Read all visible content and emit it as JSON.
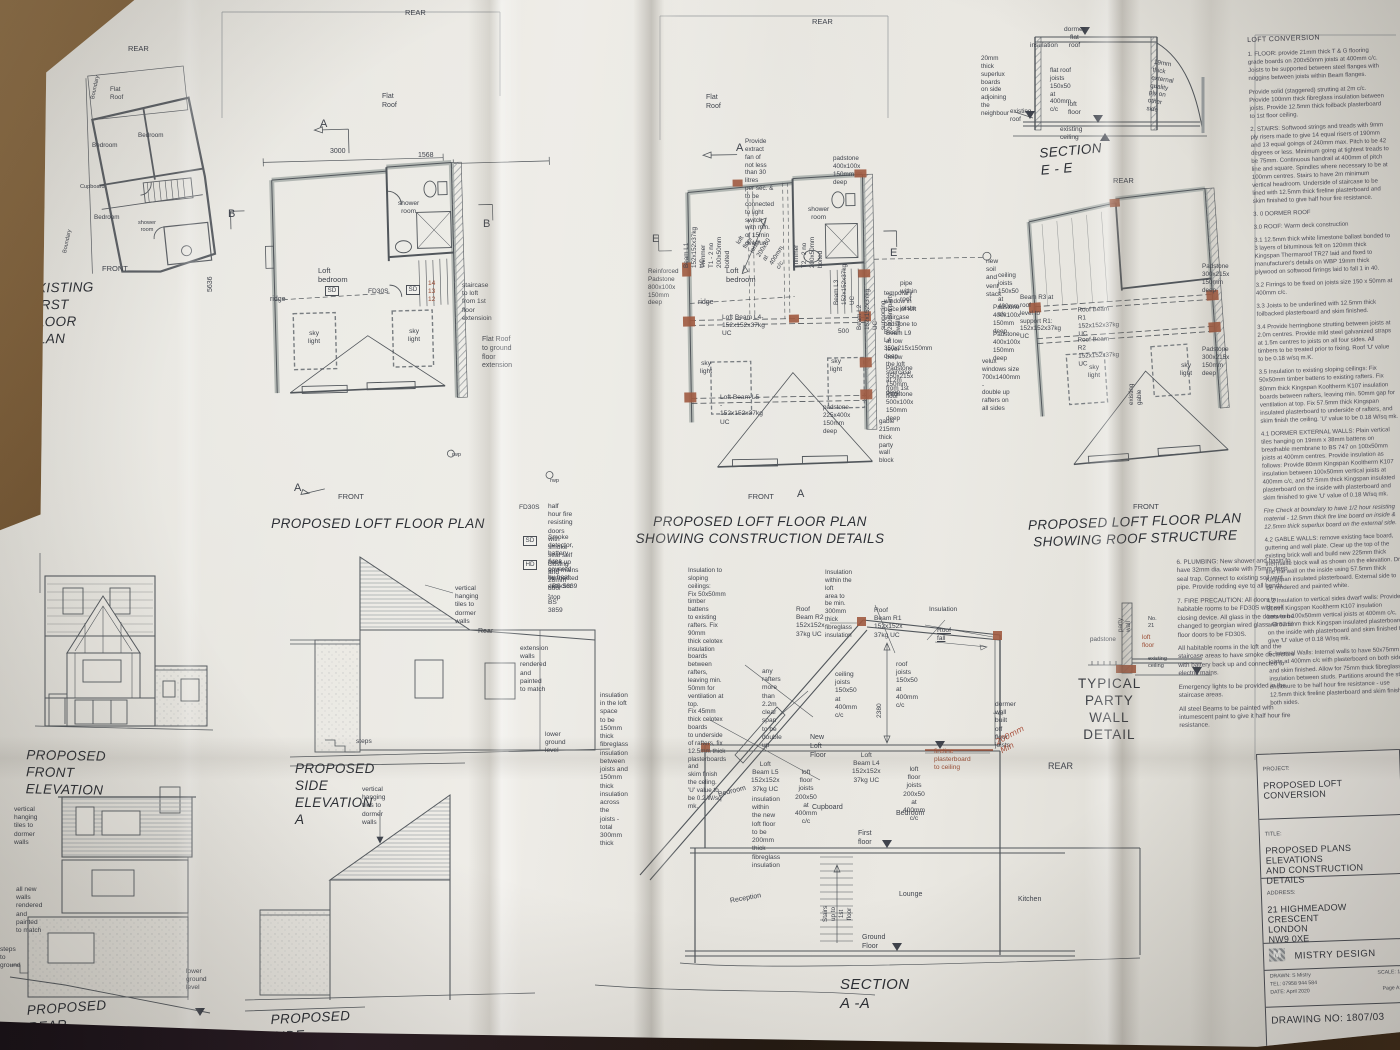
{
  "colors": {
    "paper": "#e8e6e0",
    "wood_light": "#8a6a44",
    "wood_dark": "#3a2a18",
    "accent_red": "#9a4c33",
    "line": "#565b60"
  },
  "panels": {
    "existing": {
      "title": "EXISTING FIRST FLOOR PLAN",
      "rear": "REAR",
      "front": "FRONT",
      "flat_roof": "Flat Roof",
      "boundary_top": "Boundary",
      "boundary_bottom": "Boundary",
      "bedroom_a": "Bedroom",
      "bedroom_b": "Bedroom",
      "bedroom_c": "Bedroom",
      "cupboard": "Cupboard",
      "shower": "shower\nroom"
    },
    "loft": {
      "title": "PROPOSED LOFT FLOOR PLAN",
      "rear": "REAR",
      "front": "FRONT",
      "flat_roof": "Flat Roof",
      "marker_a": "A",
      "marker_a2": "A",
      "marker_b": "B",
      "marker_b2": "B",
      "dim_width": "3000",
      "dim_width2": "1568",
      "dim_height": "5636",
      "shower_room": "shower\nroom",
      "loft_bedroom": "Loft bedroom",
      "sd": "SD",
      "sd2": "SD",
      "fd30s": "FD30S",
      "stair_numbers": "14 13 12",
      "staircase_note": "staircase to loft\nfrom 1st floor\nextensioin",
      "ridge": "ridge",
      "skylight": "sky\nlight",
      "skylight2": "sky\nlight",
      "flat_roof_note": "Flat Roof to ground\nfloor extension",
      "rwp": "rwp",
      "rwp2": "rwp"
    },
    "legend": {
      "fd_key": "FD30S",
      "fd_text": "half hour fire resisting doors with\nsmoke seal self closing and 25mm\ndoor stop",
      "sd_key": "SD",
      "sd_text": "Smoke detector, battery back up\nand mains connected - BS 5839",
      "hd_key": "HD",
      "hd_text": "Area covered by heat detector -\nBS 3859"
    },
    "construction": {
      "title": "PROPOSED LOFT FLOOR PLAN\nSHOWING CONSTRUCTION DETAILS",
      "rear": "REAR",
      "front": "FRONT",
      "flat_roof": "Flat Roof",
      "marker_a": "A",
      "marker_a2": "A",
      "marker_e": "E",
      "marker_e2": "E",
      "fan_note": "Provide extract fan of\nnot less than 30 litres\nper sec. & to be\nconnected to light switch\nwith min. of 15min\noverrun.",
      "padstone_top": "padstone\n400x100x\n150mm deep",
      "beam_l1": "Beam L1 152x152x37kg UC",
      "trimmer_t1": "Trimmer T1 - 2 no\n200x50mm bolted",
      "floor_joists": "loft floor joists\n200x50 at\n400mm c/c",
      "trimmer_t2": "Trimmer T2 - 2 no\n200x50mm bolted",
      "shower_room": "shower\nroom",
      "loft_bedroom": "Loft bedroom",
      "beam_l3": "Beam L3 152x152x37kg UC",
      "beam_l2": "Beam L2 152x152x37kg UC\nsupporting 200mm party wall",
      "soil_stack": "new soil and\nvent stack",
      "pipe_note": "pipe within roof joists",
      "reinforced_padstone": "Reinforced\nPadstone\n800x100x\n150mm deep",
      "temp_window": "temporary window in\nplace of loft staircase\npadstone to Beam\nL4 350x215x150mm\ndeep",
      "beam_l9": "Beam L9 at low\nlevel below the loft\nstaircase at 2m\nfrom 1st floor",
      "ridge": "ridge",
      "beam_l4": "Loft Beam L4- 152x152x37kg UC",
      "dim_500": "500",
      "skylight": "sky\nlight",
      "skylight2": "sky\nlight",
      "beam_l5": "Loft Beam L5 - 152x152x37kg UC",
      "padstone_225": "padstone\n225x400x\n150mm deep",
      "padstone_350": "Padstone\n350x215x\n150mm deep",
      "padstone_500": "Padstone\n500x100x\n150mm deep",
      "gable_note": "gable 215mm thick\nparty wall block"
    },
    "roof": {
      "title": "PROPOSED LOFT FLOOR PLAN\nSHOWING ROOF STRUCTURE",
      "rear": "REAR",
      "front": "FRONT",
      "ceiling_joists": "ceiling joists\n150x50 at\n400mm c/c",
      "padstone_400a": "Padstone\n400x100x\n150mm deep",
      "padstone_400b": "Padstone\n400x100x\n150mm deep",
      "velux_note": "velux windows size\n700x1400mm -\ndouble up rafters on\nall sides",
      "beam_r3": "Beam R3 at roof\nlevel to support R1:\n152x152x37kg UC",
      "roof_beam_r1": "Roof Beam R1 152x152x37kg UC",
      "roof_beam_r2": "Roof Beam R2 152x152x37kg UC",
      "padstone_300a": "Padstone\n300x215x\n150mm deep",
      "padstone_300b": "Padstone\n300x215x\n150mm deep",
      "skylight": "sky\nlight",
      "skylight2": "sky\nlight",
      "existing_gable": "existing\ngable"
    },
    "section_ee": {
      "title": "SECTION E - E",
      "insulation": "insulation",
      "dormer_roof": "dormer flat\nroof",
      "superlux": "20mm thick\nsuperlux boards\non side adjoining\nthe neighbour",
      "flat_roof_joists": "flat roof joists\n150x50 at\n400mm c/c",
      "ply": "19mm thick\nexternal quality\nply on other side",
      "existing_roof": "existing\nroof",
      "loft_floor": "loft floor",
      "existing_ceiling": "existing ceiling"
    },
    "notes": {
      "heading": "LOFT CONVERSION",
      "items": [
        "1. FLOOR: provide 21mm thick T & G flooring grade boards on 200x50mm joists at 400mm c/c. Joists to be supported between steel flanges with noggins between joists within Beam flanges.",
        "Provide solid (staggered) strutting at 2m c/c. Provide 100mm thick fibreglass insulation between joists. Provide 12.5mm thick foilback plasterboard to 1st floor ceiling.",
        "2. STAIRS: Softwood strings and treads with 9mm ply risers made to give 14 equal risers of 190mm and 13 equal goings of 240mm max. Pitch to be 42 degrees or less. Minimum going at tightest treads to be 75mm. Continuous handrail at 400mm of pitch line and square. Spindles where necessary to be at 100mm centres. Stairs to have 2m minimum vertical headroom. Underside of staircase to be lined with 12.5mm thick fireline plasterboard and skim finished to give half hour fire resistance.",
        "3. 0 DORMER ROOF",
        "3.0 ROOF: Warm deck construction",
        "3.1 12.5mm thick white limestone ballast bonded to 3 layers of bituminous felt on 120mm thick Kingspan Thermaroof TR27 laid and fixed to manufacturer's details on WBP 19mm thick plywood on softwood firrings laid to fall 1 in 40.",
        "3.2 Firrings to be fixed on joists size 150 x 50mm at 400mm c/c.",
        "3.3 Joists to be underlined with 12.5mm thick foilbacked plasterboard and skim finished.",
        "3.4 Provide herringbone strutting between joists at 2.0m centres. Provide mild steel galvanized straps at 1.5m centres to joists on all four sides. All timbers to be treated prior to fixing. Roof 'U' value to be 0.18 w/sq m.K.",
        "3.5 Insulation to existing sloping ceilings: Fix 50x50mm timber battens to existing rafters. Fix 80mm thick Kingspan Kooltherm K107 insulation boards between rafters, leaving min. 50mm gap for ventilation at top. Fix 57.5mm thick Kingspan insulated plasterboard to underside of rafters, and skim finish the ceiling. 'U' value to be 0.18 W/sq mk.",
        "4.1 DORMER EXTERNAL WALLS: Plain vertical tiles hanging on 19mm x 38mm battens on breathable membrane to BS 747 on 100x50mm joists at 400mm centres. Provide insulation as follows: Provide 80mm Kingspan Kooltherm K107 insulation between 100x50mm vertical joists at 400mm c/c, and 57.5mm thick Kingspan insulated plasterboard on the inside with plasterboard and skim finished to give 'U' value of 0.18 W/sq mk.",
        "Fire Check at boundary to have 1/2 hour resisting material - 12.5mm thick fire line board on inside & 12.5mm thick superlux board on the external side.",
        "4.2 GABLE WALLS: remove existing face board, guttering and wall plate. Clear up the top of the existing brick wall and build new 225mm thick thermalite block wall as shown on the elevation. Dry line the wall on the inside using 57.5mm thick Kingspan insulated plasterboard. External side to be rendered and painted white.",
        "4.2 Insulation to vertical sides dwarf walls: Provide 80mm Kingspan Kooltherm K107 insulation between 100x50mm vertical joists at 400mm c/c, and 57.5mm thick Kingspan insulated plasterboard on the inside with plasterboard and skim finished to give 'U' value of 0.18 W/sq mk.",
        "5. Internal Walls: Internal walls to have 50x75mm joists at 400mm c/c with plasterboard on both sides and skim finished. Allow for 75mm thick fibreglass insulation between studs. Partitions around the stair enclosure to be half hour fire resistance - use 12.5mm thick fireline plasterboard and skim finish both sides."
      ]
    },
    "front_elev": {
      "title": "PROPOSED FRONT ELEVATION"
    },
    "side_elev": {
      "title": "PROPOSED  SIDE ELEVATION A",
      "tiles_note": "vertical hanging\ntiles to dormer walls",
      "rear": "Rear",
      "ext_walls": "extension walls\nrendered and\npainted to match",
      "steps": "steps",
      "lower_ground": "lower ground\nlevel"
    },
    "rear_elev": {
      "title": "PROPOSED REAR ELEVATION",
      "tiles_note": "vertical hanging\ntiles to dormer walls",
      "walls_note": "all new walls rendered and\npainted to match",
      "steps_note": "steps to ground",
      "lower_ground": "lower ground\nlevel"
    },
    "side_elev2": {
      "title": "PROPOSED  SIDE ELEVATION A",
      "tiles_note": "vertical hanging\ntiles to dormer walls"
    },
    "section_aa": {
      "title": "SECTION A -A",
      "insul_sloping": "Insulation to sloping ceilings:\nFix 50x50mm timber battens\nto existing rafters. Fix 90mm\nthick celotex insulation boards\nbetween rafters, leaving min.\n50mm for ventilation at top.\nFix 45mm thick celotex boards\nto underside of rafters, fix\n12.5mm thick plasterboards and\nskim finish the celing.\n'U' value to be 0.2 W/sq mk.",
      "insul_loft": "Insulation within the loft\narea to be min. 300mm\nthick fibreglass insulation",
      "roof_beam_r2": "Roof Beam R2\n152x152x\n37kg UC",
      "roof_beam_r1": "Roof Beam R1\n152x152x\n37kg UC",
      "insulation": "Insulation",
      "roof_fall": "Roof fall",
      "rafters_note": "any rafters more than\n2.2m clear span to be\ndouble up",
      "insul_space": "insulation in the loft space\nto be 150mm thick\nfibreglass insulation\nbetween joists and 150mm\nthick insulation across the\njoists - total 300mm thick",
      "ceiling_joists": "ceiling joists\n150x50 at\n400mm c/c",
      "roof_joists": "roof joists\n150x50 at\n400mm c/c",
      "dim_2380": "2380",
      "new_loft_floor": "New Loft Floor",
      "dormer_wall": "dormer wall\nbuilt off floor\njoists",
      "hand_note": "200mm\nMin",
      "fireline": "fireline\nplasterboard\nto ceiling",
      "loft_beam_l5": "Loft Beam L5\n152x152x\n37kg UC",
      "loft_beam_l4": "Loft Beam L4\n152x152x\n37kg UC",
      "floor_joists": "loft floor joists\n200x50 at\n400mm c/c",
      "floor_joists2": "loft floor joists\n200x50 at\n400mm c/c",
      "insul_new_floor": "insulation within\nthe new loft floor\nto be 200mm\nthick fibreglass\ninsulation",
      "bedroom_l": "Bedroom",
      "cupboard": "Cupboard",
      "bedroom_r": "Bedroom",
      "first_floor": "First floor",
      "reception": "Reception",
      "stairs": "Stairs up to\n1st floor",
      "lounge": "Lounge",
      "kitchen": "Kitchen",
      "ground_floor": "Ground Floor",
      "rear": "REAR"
    },
    "party_wall": {
      "title": "TYPICAL PARTY\nWALL DETAIL",
      "party_wall": "party wall",
      "neighbour": "No. 21",
      "padstone": "padstone",
      "loft_floor": "loft floor",
      "existing_ceiling": "existing\nceiling",
      "rear": "REAR"
    },
    "site_notes": {
      "plumbing": "6. PLUMBING:\nNew shower and basin to have 32mm dia. waste with 75mm deep seal trap. Connect to existing soil vent pipe. Provide rodding eye to all bends.",
      "fire": "7. FIRE PRECAUTION:\nAll doors to habitable rooms to be FD30S with self closing device. All glass in the doors to be changed to georgian wired glass. Ground floor doors to be FD30S.",
      "fire2": "All habitable rooms in the loft and the staircase areas to have smoke dectectors with battery back up and connected to electric mains.",
      "fire3": "Emergency lights to be provided in the staircase areas.",
      "fire4": "All steel Beams to be painted with intumescent paint to give it half hour fire resistance."
    },
    "title_block": {
      "project_label": "PROJECT:",
      "project": "PROPOSED LOFT CONVERSION",
      "title_label": "TITLE:",
      "title": "PROPOSED PLANS ELEVATIONS\nAND CONSTRUCTION DETAILS",
      "address_label": "ADDRESS:",
      "address": "21 HIGHMEADOW CRESCENT\nLONDON\nNW9 0XE",
      "firm": "MISTRY DESIGN",
      "logo_letter": "M",
      "drawn": "DRAWN: S Mistry",
      "tel": "TEL: 07958 944 584",
      "date": "DATE: April 2020",
      "scale": "SCALE: 1:",
      "page": "Page A1",
      "drawing_no": "DRAWING NO: 1807/03"
    }
  }
}
